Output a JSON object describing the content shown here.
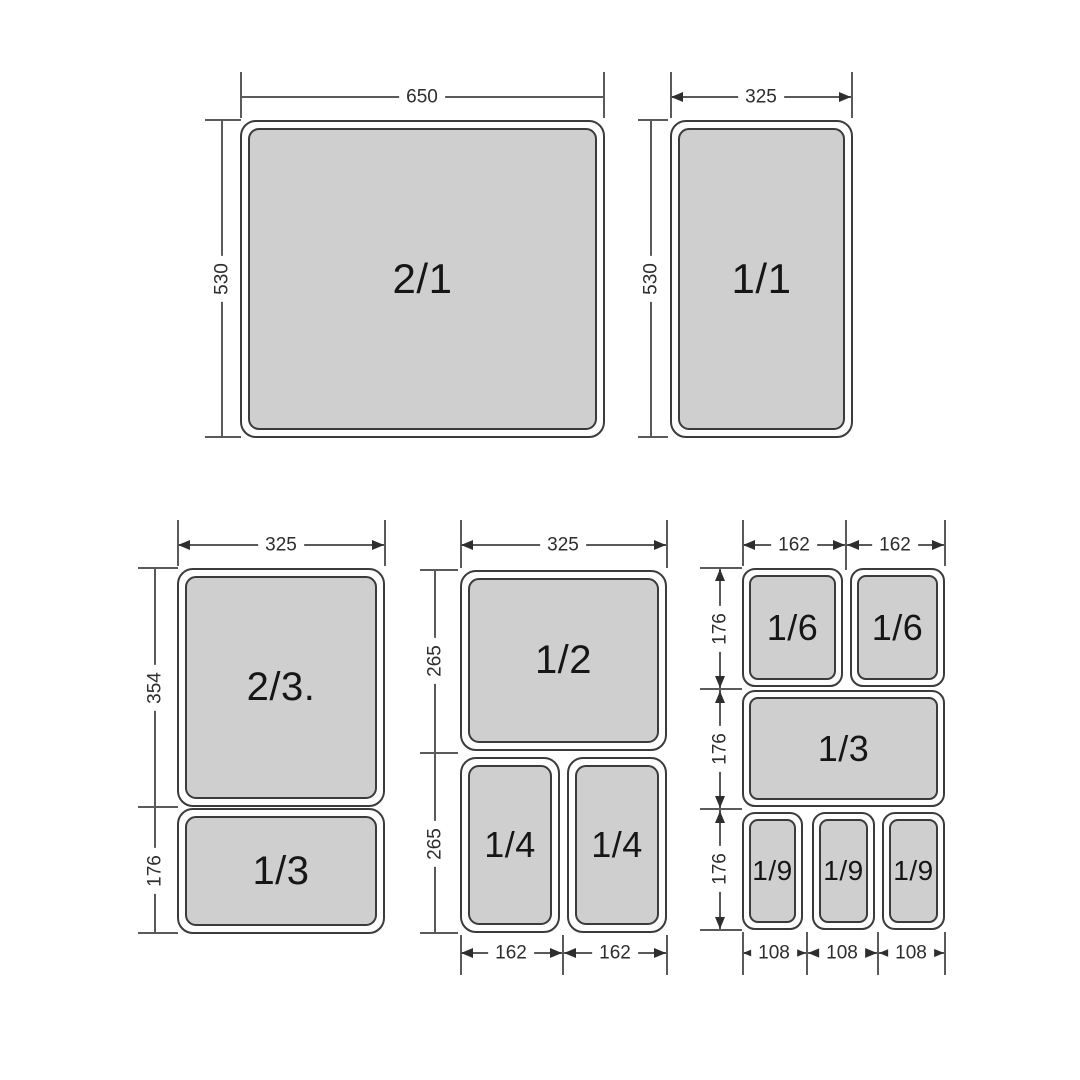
{
  "groups": {
    "top_left": {
      "pan": "2/1",
      "width": "650",
      "height": "530"
    },
    "top_right": {
      "pan": "1/1",
      "width": "325",
      "height": "530"
    },
    "bottom_left": {
      "width": "325",
      "pan1": "2/3.",
      "pan1_height": "354",
      "pan2": "1/3",
      "pan2_height": "176"
    },
    "bottom_middle": {
      "width": "325",
      "pan1": "1/2",
      "row1_height": "265",
      "pan2a": "1/4",
      "pan2b": "1/4",
      "row2_height": "265",
      "col1_width": "162",
      "col2_width": "162"
    },
    "bottom_right": {
      "col1_width": "162",
      "col2_width": "162",
      "row1_pan1": "1/6",
      "row1_pan2": "1/6",
      "row1_height": "176",
      "row2_pan": "1/3",
      "row2_height": "176",
      "row3_pan1": "1/9",
      "row3_pan2": "1/9",
      "row3_pan3": "1/9",
      "row3_height": "176",
      "bot1_width": "108",
      "bot2_width": "108",
      "bot3_width": "108"
    }
  },
  "colors": {
    "pan_fill": "#cfcfd0",
    "outline": "#3b3b3b",
    "dim_line": "#5a5a5a",
    "dim_text": "#2d2d2d"
  }
}
